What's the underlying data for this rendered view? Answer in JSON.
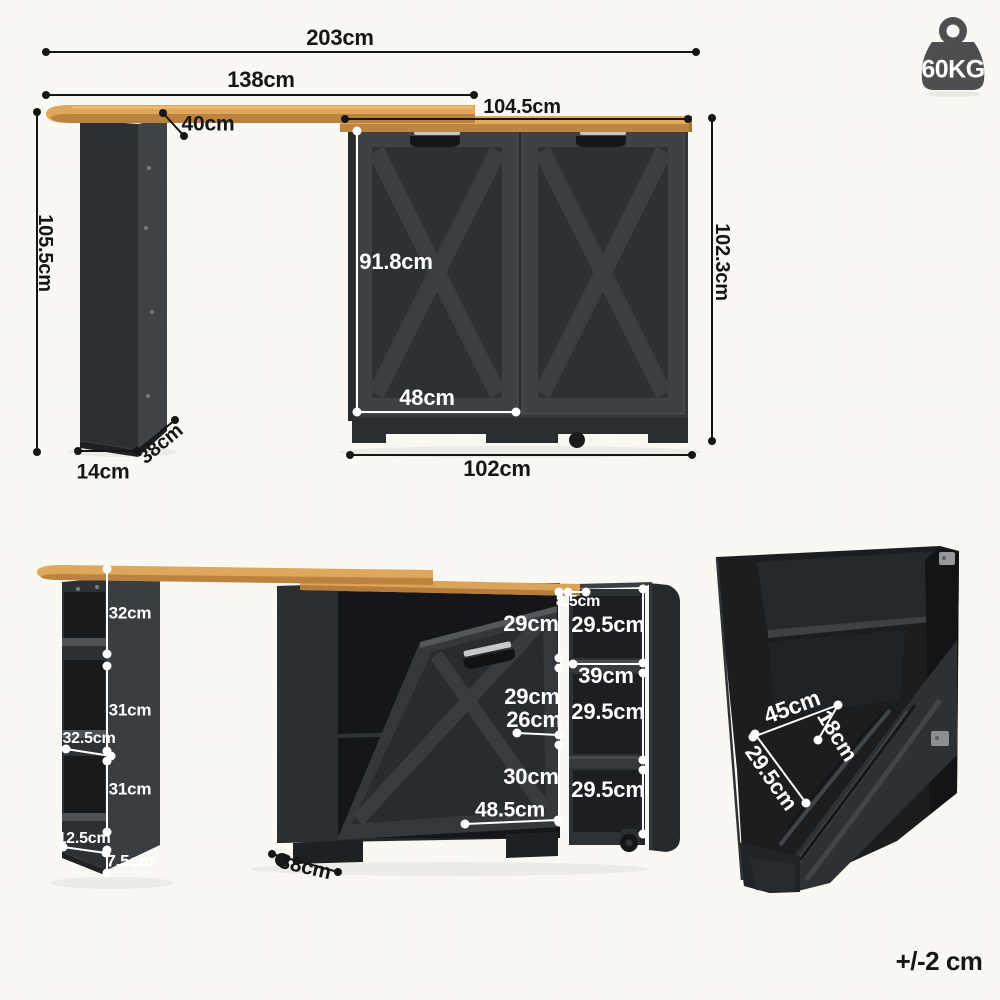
{
  "tolerance_note": "+/-2 cm",
  "weight_badge": {
    "value": "60KG",
    "icon": "weight-kettlebell-icon",
    "color": "#4e4e50"
  },
  "colors": {
    "background": "#faf8f2",
    "wood_top": "#dfa75c",
    "wood_edge": "#bc8340",
    "cabinet_body": "#35393c",
    "dimension_line_dark": "#161616",
    "dimension_line_light": "#ffffff"
  },
  "assembled_view": {
    "total_width": "203cm",
    "bar_length": "138cm",
    "cabinet_top_width": "104.5cm",
    "bar_depth": "40cm",
    "bar_height": "105.5cm",
    "cabinet_height": "102.3cm",
    "door_height": "91.8cm",
    "door_width": "48cm",
    "cabinet_width": "102cm",
    "leg_width": "14cm",
    "leg_depth": "38cm"
  },
  "folded_view": {
    "shelf_top_section": "32cm",
    "shelf_middle_section": "31cm",
    "shelf_middle_depth": "32.5cm",
    "shelf_bottom_section": "31cm",
    "shelf_bottom_depth": "12.5cm",
    "plinth_height": "7.5cm",
    "cabinet_depth": "38cm",
    "top_compartment": "29cm",
    "gap_width": "8.5cm",
    "middle_compartment": "29cm",
    "middle_opening_depth": "26cm",
    "bottom_compartment": "30cm",
    "tilt_door_width": "48.5cm",
    "cart_top_compartment": "29.5cm",
    "cart_depth": "39cm",
    "cart_middle_compartment": "29.5cm",
    "cart_bottom_compartment": "29.5cm"
  },
  "detail_view": {
    "opening_width": "45cm",
    "opening_depth": "18cm",
    "door_panel_depth": "29.5cm"
  }
}
